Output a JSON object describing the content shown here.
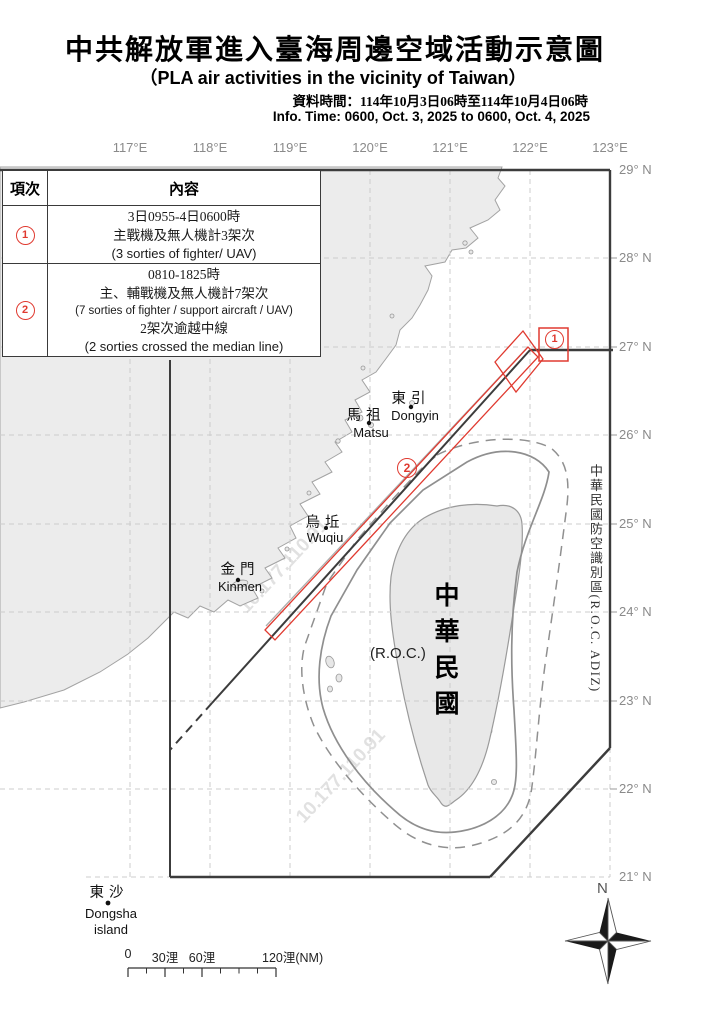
{
  "header": {
    "title_zh": "中共解放軍進入臺海周邊空域活動示意圖",
    "title_en": "（PLA air activities in the vicinity of Taiwan）",
    "info_zh": "資料時間：114年10月3日06時至114年10月4日06時",
    "info_en": "Info. Time: 0600, Oct. 3, 2025 to 0600, Oct. 4, 2025"
  },
  "legend_table": {
    "col_item": "項次",
    "col_content": "內容",
    "rows": [
      {
        "num": "1",
        "l1": "3日0955-4日0600時",
        "l2": "主戰機及無人機計3架次",
        "l3": "(3 sorties of fighter/ UAV)"
      },
      {
        "num": "2",
        "l1": "0810-1825時",
        "l2": "主、輔戰機及無人機計7架次",
        "l3": "(7 sorties of fighter / support aircraft / UAV)",
        "l4": "2架次逾越中線",
        "l5": "(2 sorties crossed the median line)"
      }
    ]
  },
  "map": {
    "lon_labels": [
      "117°E",
      "118°E",
      "119°E",
      "120°E",
      "121°E",
      "122°E",
      "123°E"
    ],
    "lat_labels": [
      "29° N",
      "28° N",
      "27° N",
      "26° N",
      "25° N",
      "24° N",
      "23° N",
      "22° N",
      "21° N"
    ],
    "places": {
      "dongyin_zh": "東引",
      "dongyin_en": "Dongyin",
      "matsu_zh": "馬祖",
      "matsu_en": "Matsu",
      "wuqiu_zh": "烏坵",
      "wuqiu_en": "Wuqiu",
      "kinmen_zh": "金門",
      "kinmen_en": "Kinmen",
      "dongsha_zh": "東沙",
      "dongsha_en": "Dongsha",
      "dongsha_en2": "island"
    },
    "taiwan_zh": "中華民國",
    "taiwan_en": "(R.O.C.)",
    "adiz_label": "中華民國防空識別區(R.O.C. ADIZ)",
    "annotation_1": "1",
    "annotation_2": "2",
    "watermark": "10.177.110.91",
    "compass": "N",
    "scalebar": {
      "t0": "0",
      "t30": "30浬",
      "t60": "60浬",
      "t120": "120浬(NM)"
    },
    "colors": {
      "red": "#e03a30",
      "land": "#ececec",
      "coast": "#a3a3a3",
      "grid": "#cccccc",
      "adiz_line": "#3c3c3c",
      "graticule_label": "#8a8a8a"
    }
  }
}
